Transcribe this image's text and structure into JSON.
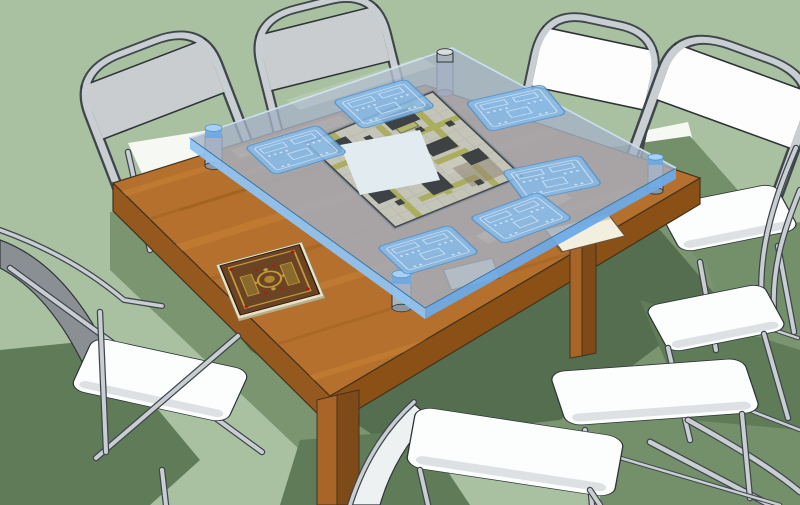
{
  "scene": {
    "description": "SketchUp-style 3D rendering of a square wooden gaming table with a raised translucent blue glass top over a dungeon battle map, six translucent blue player trays resting on the glass, an ornate rulebook and two thin books, four cylindrical glass standoffs, and eight metal folding chairs with white seats arranged around the table on a sage green floor",
    "counts": {
      "folding_chairs": 8,
      "player_trays": 6,
      "glass_standoffs": 4,
      "books": 3
    }
  },
  "colors": {
    "floor": "#a9c0a1",
    "floor_highlight": "#f6f8f3",
    "floor_shadow_soft": "#74906a",
    "floor_shadow": "#5f7b58",
    "floor_shadow_dark": "#4d6749",
    "wood_top": "#b4702c",
    "wood_side": "#95591f",
    "wood_side_dark": "#8a5016",
    "wood_leg": "#a86527",
    "wood_leg_dark": "#7e4a18",
    "wood_grain_light": "#cd8638",
    "wood_grain_dark": "#9a5c1f",
    "wood_outline": "#45321c",
    "glass_fill": "#a5b2c6",
    "glass_veil": "#a9c6e8",
    "glass_edge_band": "#6eaae6",
    "glass_edge_band_light": "#8fc3f1",
    "glass_outline": "#3f759f",
    "standoff_gray": "#aab3ba",
    "standoff_top": "#d8dde1",
    "standoff_blue": "#6fa9e2",
    "tray_fill": "#87bae8",
    "tray_line": "#d3e8fb",
    "tray_edge": "#4f93cf",
    "map_floor": "#cdc5a8",
    "map_dark": "#1a150c",
    "map_path": "#aaa72f",
    "map_room": "#b5b243",
    "map_brown": "#8a6f4a",
    "chair_frame": "#c9ced3",
    "chair_frame_outline": "#3f464c",
    "chair_panel_gray": "#c9cdd0",
    "chair_panel_white": "#fdfdfd",
    "chair_seat": "#fcfdfd",
    "chair_seat_shade": "#d8dcdf",
    "chair_back_dark": "#8a8f94",
    "book_page": "#e9e2c8",
    "book_cover": "#6b4423",
    "book_gold": "#c49a3c",
    "book_gem": "#a31f1f",
    "outline": "#2e3338"
  }
}
